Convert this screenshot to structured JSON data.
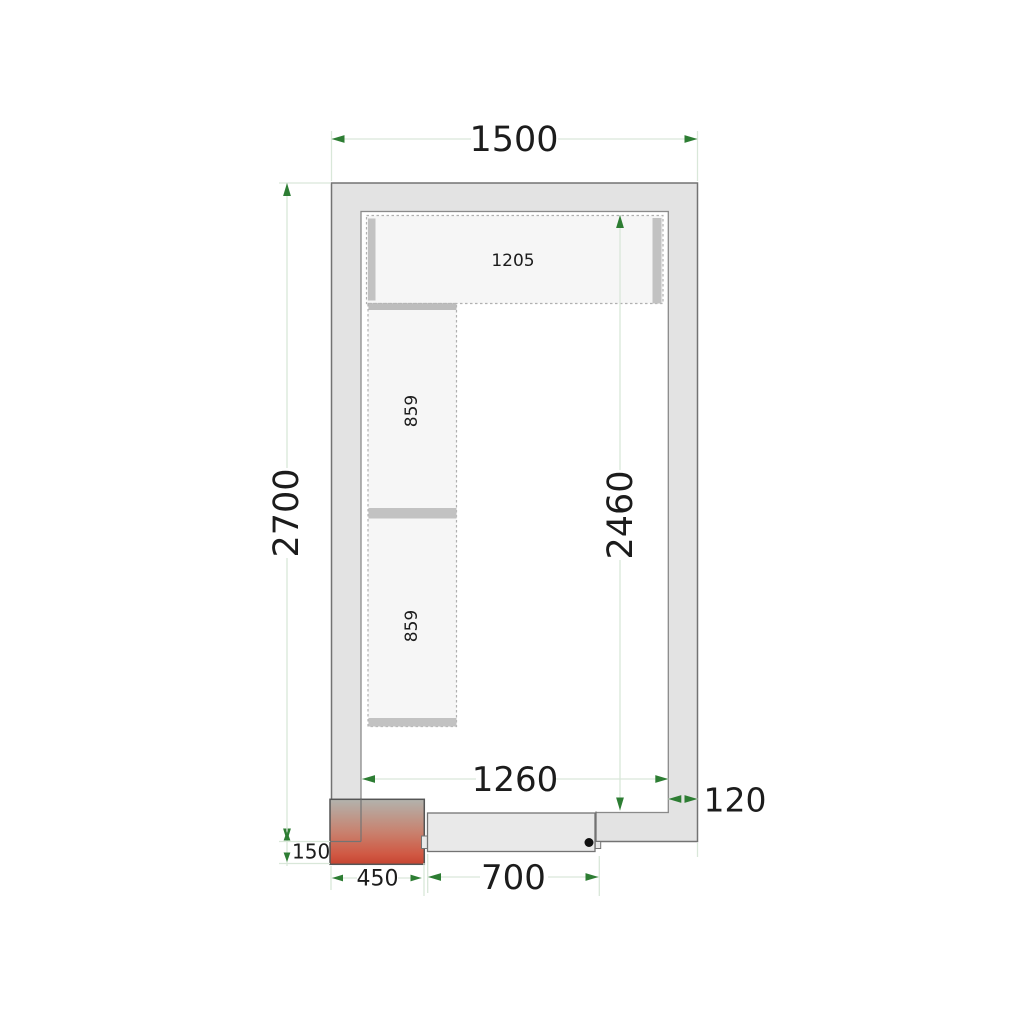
{
  "drawing": {
    "type": "cold-room floor plan, top view, dimensioned technical drawing",
    "dims": {
      "overall_width": "1500",
      "overall_depth": "2700",
      "interior_width": "1260",
      "interior_depth": "2460",
      "wall_thickness": "120",
      "door_width": "700",
      "unit_width": "450",
      "unit_protrusion": "150",
      "top_shelf_length": "1205",
      "left_shelf_upper_length": "859",
      "left_shelf_lower_length": "859"
    },
    "colors": {
      "dimension_line": "#d9e7d9",
      "dimension_arrow": "#2d7d33",
      "text": "#1c1c1c",
      "wall_fill": "#e3e3e3",
      "wall_stroke": "#737373",
      "inner_stroke": "#8a8a8a",
      "shelf_fill": "#f6f6f6",
      "shelf_dash": "#b0b0b0",
      "shelf_bar": "#c2c2c2",
      "door_fill": "#e9e9e9",
      "unit_gradient_top": "#b2b3ad",
      "unit_gradient_mid": "#c8826f",
      "unit_gradient_bottom": "#c64531",
      "door_handle_dot": "#111111"
    }
  }
}
